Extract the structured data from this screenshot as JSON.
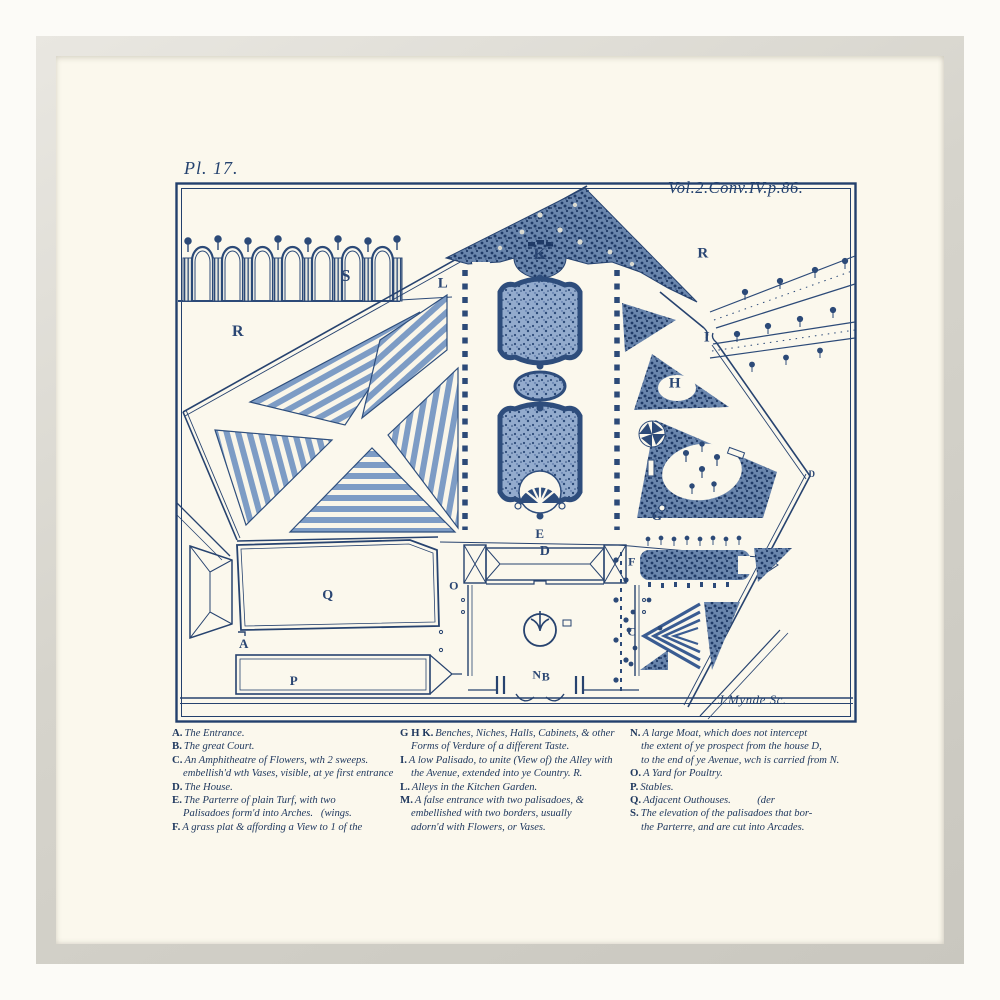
{
  "artwork": {
    "plate_number": "Pl. 17.",
    "volume_reference": "Vol.2.Conv.IV.p.86.",
    "engraver_signature": "J.Mynde Sc.",
    "colors": {
      "ink": "#24426f",
      "stripe_blue": "#7d9cc5",
      "grove_fill": "#6a86ad",
      "paper": "#fbf8ed",
      "frame": "#fcfbf7",
      "mat_lip": "#cfccc3"
    },
    "plan_letters": [
      {
        "label": "R",
        "x": 238,
        "y": 332,
        "s": 16
      },
      {
        "label": "S",
        "x": 346,
        "y": 276,
        "s": 17
      },
      {
        "label": "L",
        "x": 443,
        "y": 284,
        "s": 15
      },
      {
        "label": "K",
        "x": 540,
        "y": 255,
        "s": 16
      },
      {
        "label": "R",
        "x": 703,
        "y": 254,
        "s": 15
      },
      {
        "label": "I",
        "x": 707,
        "y": 338,
        "s": 15
      },
      {
        "label": "H",
        "x": 675,
        "y": 384,
        "s": 15
      },
      {
        "label": "G",
        "x": 657,
        "y": 516,
        "s": 13
      },
      {
        "label": "D",
        "x": 812,
        "y": 474,
        "s": 9
      },
      {
        "label": "E",
        "x": 540,
        "y": 534,
        "s": 13
      },
      {
        "label": "D",
        "x": 545,
        "y": 552,
        "s": 14
      },
      {
        "label": "F",
        "x": 632,
        "y": 562,
        "s": 12
      },
      {
        "label": "C",
        "x": 632,
        "y": 632,
        "s": 12
      },
      {
        "label": "Q",
        "x": 328,
        "y": 596,
        "s": 14
      },
      {
        "label": "O",
        "x": 454,
        "y": 586,
        "s": 12
      },
      {
        "label": "A",
        "x": 244,
        "y": 644,
        "s": 13
      },
      {
        "label": "P",
        "x": 294,
        "y": 681,
        "s": 13
      },
      {
        "label": "N",
        "x": 537,
        "y": 675,
        "s": 12
      },
      {
        "label": "B",
        "x": 546,
        "y": 677,
        "s": 12
      }
    ],
    "legend": {
      "columns": [
        {
          "entries": [
            {
              "key": "A.",
              "lines": [
                "The Entrance."
              ]
            },
            {
              "key": "B.",
              "lines": [
                "The great Court."
              ]
            },
            {
              "key": "C.",
              "lines": [
                "An Amphitheatre of Flowers, wth 2 sweeps.",
                "embellish'd wth Vases, visible, at ye first entrance"
              ]
            },
            {
              "key": "D.",
              "lines": [
                "The House."
              ]
            },
            {
              "key": "E.",
              "lines": [
                "The Parterre of plain Turf, with two",
                "Palisadoes form'd into Arches.   (wings."
              ]
            },
            {
              "key": "F.",
              "lines": [
                "A grass plat & affording a View to 1 of the"
              ]
            }
          ]
        },
        {
          "entries": [
            {
              "key": "G H K.",
              "lines": [
                "Benches, Niches, Halls, Cabinets, & other",
                "Forms of Verdure of a different Taste."
              ]
            },
            {
              "key": "I.",
              "lines": [
                "A low Palisado, to unite (View of) the Alley with",
                "the Avenue, extended into ye Country. R."
              ]
            },
            {
              "key": "L.",
              "lines": [
                "Alleys in the Kitchen Garden."
              ]
            },
            {
              "key": "M.",
              "lines": [
                "A false entrance with two palisadoes, &",
                "embellished with two borders, usually",
                "adorn'd with Flowers, or Vases."
              ]
            }
          ]
        },
        {
          "entries": [
            {
              "key": "N.",
              "lines": [
                "A large Moat, which does not intercept",
                "the extent of ye prospect from the house D,",
                "to the end of ye Avenue, wch is carried from N."
              ]
            },
            {
              "key": "O.",
              "lines": [
                "A Yard for Poultry."
              ]
            },
            {
              "key": "P.",
              "lines": [
                "Stables."
              ]
            },
            {
              "key": "Q.",
              "lines": [
                "Adjacent Outhouses.          (der"
              ]
            },
            {
              "key": "S.",
              "lines": [
                "The elevation of the palisadoes that bor-",
                "the Parterre, and are cut into Arcades."
              ]
            }
          ]
        }
      ]
    }
  }
}
